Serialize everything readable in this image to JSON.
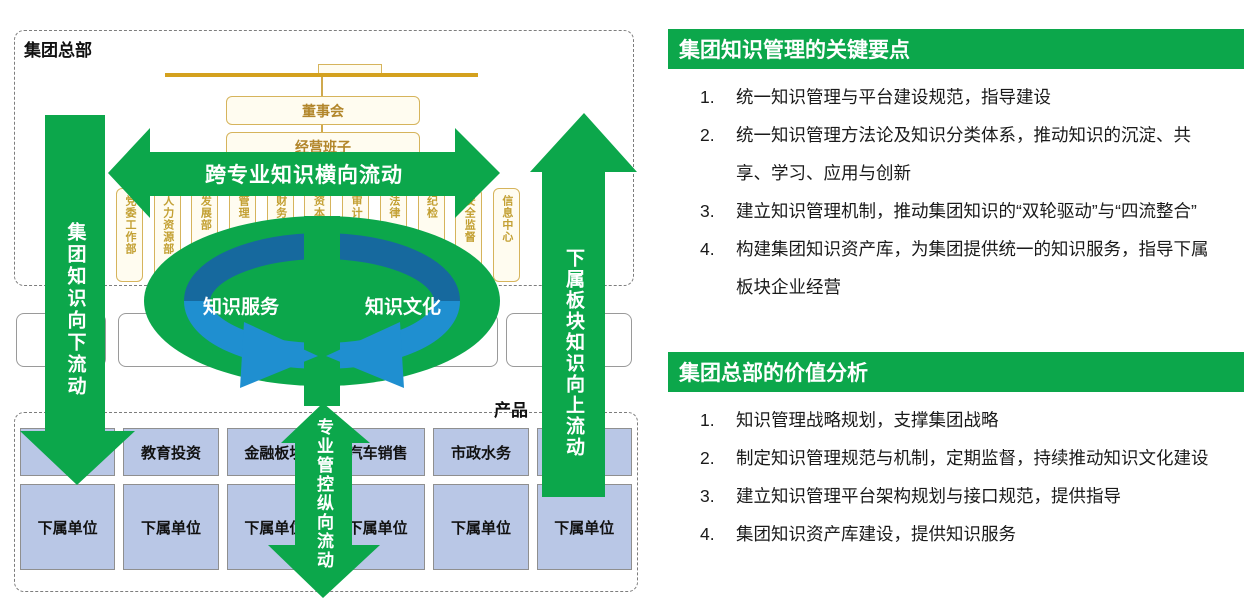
{
  "colors": {
    "green": "#0ca74b",
    "dark_blue": "#16699e",
    "light_blue": "#1f8fd0",
    "cell_blue": "#b9c7e6",
    "gold": "#d6b45c"
  },
  "left_diagram": {
    "hq_label": "集团总部",
    "org": {
      "board": "董事会",
      "management": "经营班子",
      "departments": [
        "党委工作部",
        "人力资源部",
        "发展部",
        "管理",
        "财务",
        "资本",
        "审计",
        "法律",
        "纪检",
        "安全监督",
        "信息中心"
      ]
    },
    "arrows": {
      "horizontal": "跨专业知识横向流动",
      "left_down": "集团知识向下流动",
      "right_up": "下属板块知识向上流动",
      "center_vertical": "专业管控纵向流动"
    },
    "ellipse": {
      "left_label": "知识服务",
      "right_label": "知识文化"
    },
    "product_label": "产品",
    "grid": {
      "row1": [
        "",
        "教育投资",
        "金融板块",
        "汽车销售",
        "市政水务",
        ""
      ],
      "row2": [
        "下属单位",
        "下属单位",
        "下属单位",
        "下属单位",
        "下属单位",
        "下属单位"
      ]
    }
  },
  "right_panel": {
    "sections": [
      {
        "title": "集团知识管理的关键要点",
        "items": [
          {
            "num": "1.",
            "text": "统一知识管理与平台建设规范，指导建设"
          },
          {
            "num": "2.",
            "text": "统一知识管理方法论及知识分类体系，推动知识的沉淀、共享、学习、应用与创新"
          },
          {
            "num": "3.",
            "text": "建立知识管理机制，推动集团知识的“双轮驱动”与“四流整合”"
          },
          {
            "num": "4.",
            "text": "构建集团知识资产库，为集团提供统一的知识服务，指导下属板块企业经营"
          }
        ]
      },
      {
        "title": "集团总部的价值分析",
        "items": [
          {
            "num": "1.",
            "text": "知识管理战略规划，支撑集团战略"
          },
          {
            "num": "2.",
            "text": "制定知识管理规范与机制，定期监督，持续推动知识文化建设"
          },
          {
            "num": "3.",
            "text": "建立知识管理平台架构规划与接口规范，提供指导"
          },
          {
            "num": "4.",
            "text": "集团知识资产库建设，提供知识服务"
          }
        ]
      }
    ]
  }
}
